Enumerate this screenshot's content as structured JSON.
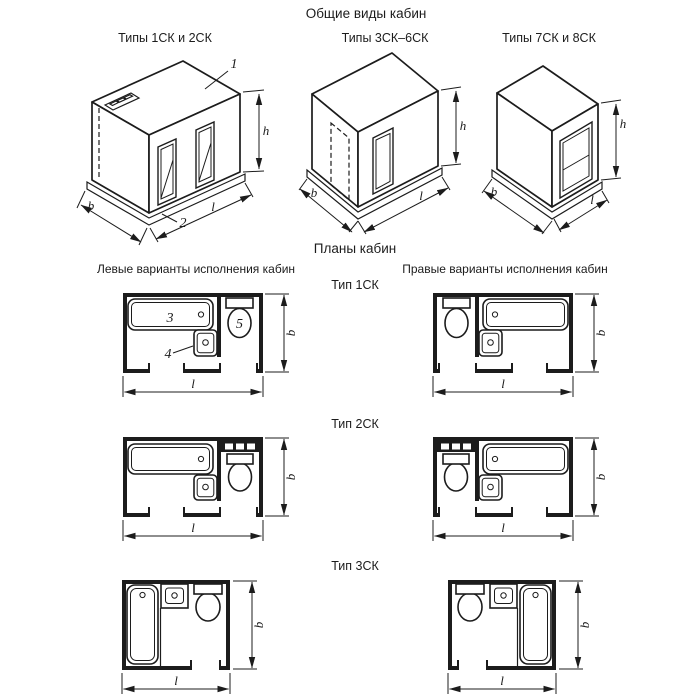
{
  "page": {
    "title": "Общие виды кабин",
    "plans_title": "Планы кабин",
    "left_column_header": "Левые варианты исполнения кабин",
    "right_column_header": "Правые варианты исполнения кабин"
  },
  "general_views": {
    "type_1_2": "Типы 1СК и 2СК",
    "type_3_6": "Типы 3СК–6СК",
    "type_7_8": "Типы 7СК и 8СК"
  },
  "plan_types": {
    "type_1": "Тип 1СК",
    "type_2": "Тип 2СК",
    "type_3": "Тип 3СК"
  },
  "dimension_labels": {
    "width": "b",
    "length": "l",
    "height": "h"
  },
  "callouts": {
    "roof_panel": "1",
    "floor_panel": "2",
    "bathtub": "3",
    "washbasin": "4",
    "toilet": "5"
  },
  "colors": {
    "ink": "#1c1c1c",
    "background": "#ffffff"
  }
}
